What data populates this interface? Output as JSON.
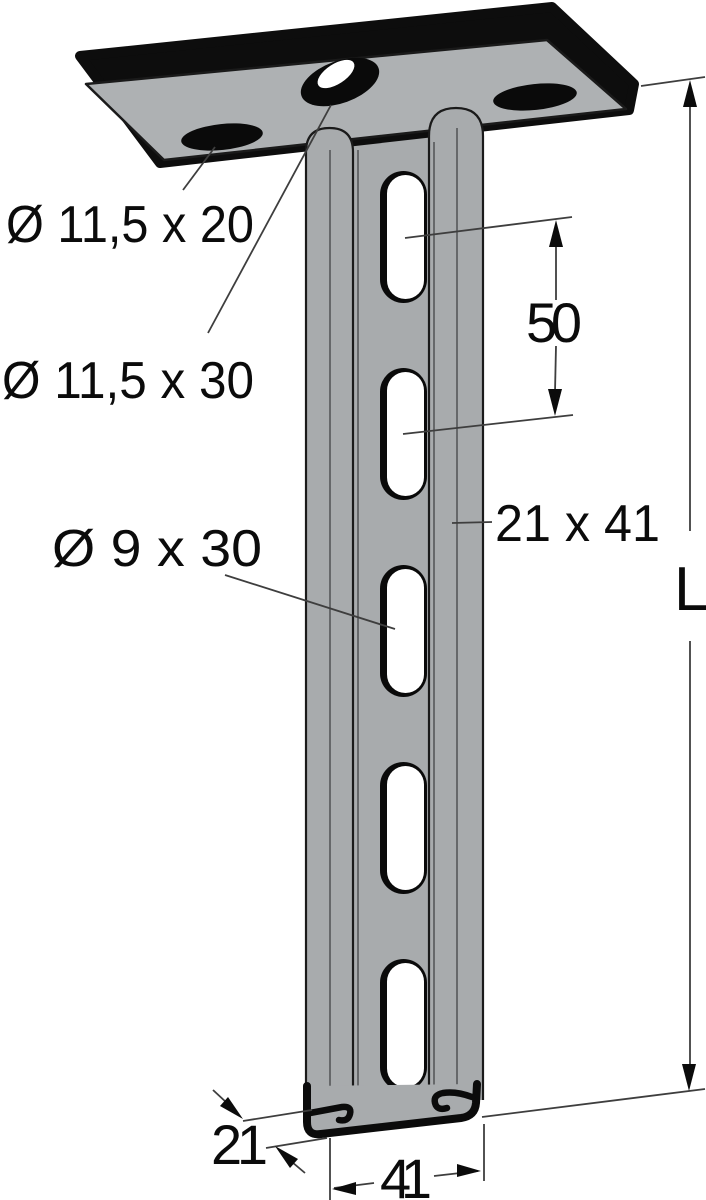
{
  "diagram": {
    "labels": {
      "plate_slot_small": "Ø 11,5 x 20",
      "plate_slot_large": "Ø 11,5 x 30",
      "channel_slot": "Ø 9 x 30",
      "slot_pitch": "50",
      "profile_size": "21 x 41",
      "length": "L",
      "profile_depth": "21",
      "profile_width": "41"
    },
    "colors": {
      "background": "#ffffff",
      "steel_gray": "#a8abad",
      "plate_gray": "#aeb1b3",
      "outline_black": "#0d0d0d",
      "dimension_line": "#3e3e3e",
      "hole_white": "#ffffff"
    }
  }
}
